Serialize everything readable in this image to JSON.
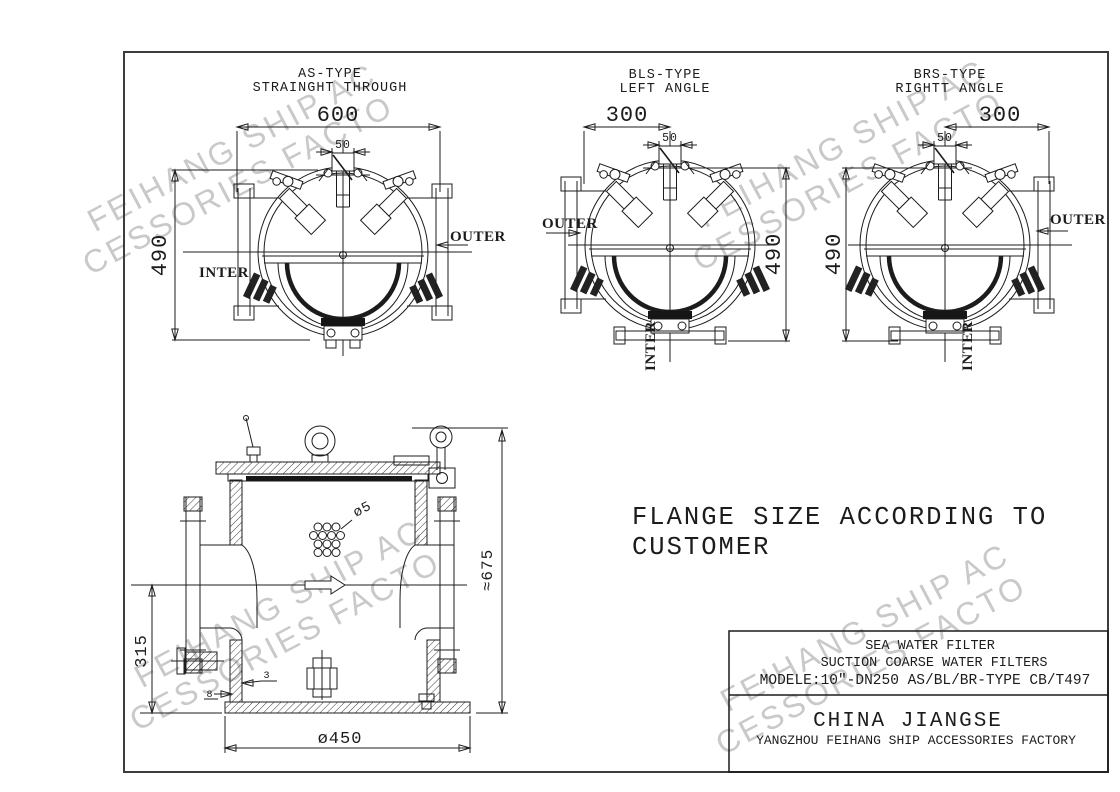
{
  "views": {
    "as": {
      "title1": "AS-TYPE",
      "title2": "STRAINGHT THROUGH",
      "dim_width": "600",
      "dim_neck": "50",
      "dim_height": "490",
      "outlet": "OUTER",
      "inlet": "INTER"
    },
    "bls": {
      "title1": "BLS-TYPE",
      "title2": "LEFT ANGLE",
      "dim_width": "300",
      "dim_neck": "50",
      "dim_height": "490",
      "outlet": "OUTER",
      "inlet": "INTER"
    },
    "brs": {
      "title1": "BRS-TYPE",
      "title2": "RIGHTT ANGLE",
      "dim_width": "300",
      "dim_neck": "50",
      "dim_height": "490",
      "outlet": "OUTER",
      "inlet": "INTER"
    }
  },
  "section": {
    "hole_dia": "ø5",
    "total_height": "≈675",
    "inlet_height": "315",
    "bottom_dia": "ø450",
    "wall_thk": "8",
    "plate_thk": "3"
  },
  "note": {
    "line1": "FLANGE SIZE ACCORDING TO",
    "line2": "CUSTOMER"
  },
  "title_block": {
    "product": "SEA WATER FILTER",
    "subtitle": "SUCTION COARSE WATER FILTERS",
    "model": "MODELE:10\"-DN250  AS/BL/BR-TYPE CB/T497",
    "company": "CHINA JIANGSE",
    "factory": "YANGZHOU FEIHANG SHIP ACCESSORIES FACTORY"
  },
  "watermark": {
    "line1": "FEIHANG SHIP AC",
    "line2": "CESSORIES FACTO"
  },
  "colors": {
    "line": "#1c1c1c",
    "watermark": "#c9c9c9",
    "border": "#3c3c3c"
  }
}
